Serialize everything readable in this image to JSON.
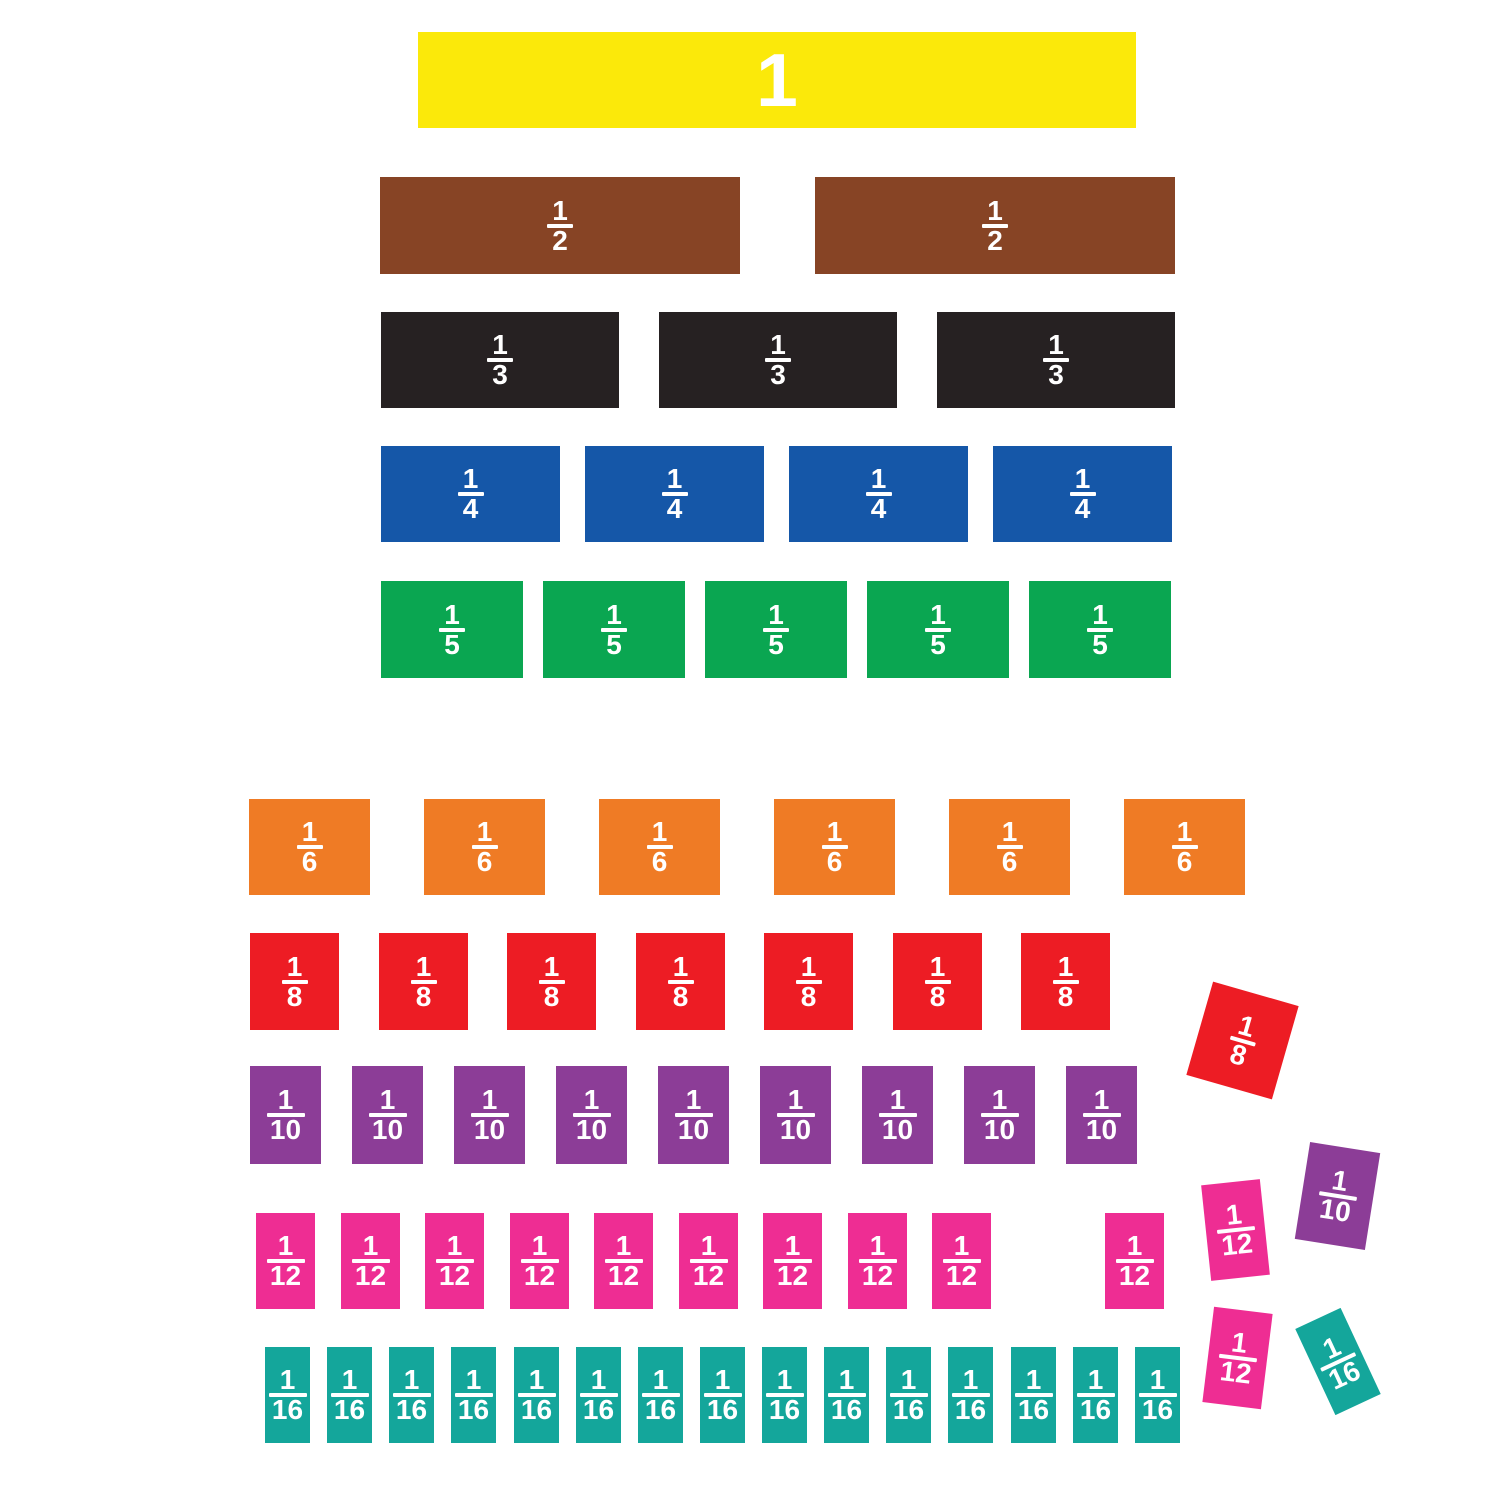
{
  "canvas": {
    "width": 1500,
    "height": 1500,
    "background": "#ffffff",
    "text_color": "#ffffff"
  },
  "rows": [
    {
      "id": "whole",
      "fraction": {
        "num": "1",
        "den": ""
      },
      "whole": true,
      "color": "#FBE90A",
      "y": 32,
      "height": 96,
      "width": 718,
      "xs": [
        418
      ]
    },
    {
      "id": "halves",
      "fraction": {
        "num": "1",
        "den": "2"
      },
      "whole": false,
      "color": "#874425",
      "y": 177,
      "height": 97,
      "width": 360,
      "xs": [
        380,
        815
      ]
    },
    {
      "id": "thirds",
      "fraction": {
        "num": "1",
        "den": "3"
      },
      "whole": false,
      "color": "#262122",
      "y": 312,
      "height": 96,
      "width": 238,
      "xs": [
        381,
        659,
        937
      ]
    },
    {
      "id": "fourths",
      "fraction": {
        "num": "1",
        "den": "4"
      },
      "whole": false,
      "color": "#1557A8",
      "y": 446,
      "height": 96,
      "width": 179,
      "xs": [
        381,
        585,
        789,
        993
      ]
    },
    {
      "id": "fifths",
      "fraction": {
        "num": "1",
        "den": "5"
      },
      "whole": false,
      "color": "#0AA651",
      "y": 581,
      "height": 97,
      "width": 142,
      "xs": [
        381,
        543,
        705,
        867,
        1029
      ]
    },
    {
      "id": "sixths",
      "fraction": {
        "num": "1",
        "den": "6"
      },
      "whole": false,
      "color": "#EF7B25",
      "y": 799,
      "height": 96,
      "width": 121,
      "xs": [
        249,
        424,
        599,
        774,
        949,
        1124
      ]
    },
    {
      "id": "eighths",
      "fraction": {
        "num": "1",
        "den": "8"
      },
      "whole": false,
      "color": "#ED1C24",
      "y": 933,
      "height": 97,
      "width": 89,
      "xs": [
        250,
        379,
        507,
        636,
        764,
        893,
        1021
      ]
    },
    {
      "id": "tenths",
      "fraction": {
        "num": "1",
        "den": "10"
      },
      "whole": false,
      "color": "#8C3D97",
      "y": 1066,
      "height": 98,
      "width": 71,
      "xs": [
        250,
        352,
        454,
        556,
        658,
        760,
        862,
        964,
        1066
      ]
    },
    {
      "id": "twelfths",
      "fraction": {
        "num": "1",
        "den": "12"
      },
      "whole": false,
      "color": "#EE2D93",
      "y": 1213,
      "height": 96,
      "width": 59,
      "xs": [
        256,
        341,
        425,
        510,
        594,
        679,
        763,
        848,
        932,
        1105
      ]
    },
    {
      "id": "sixteenths",
      "fraction": {
        "num": "1",
        "den": "16"
      },
      "whole": false,
      "color": "#14A69B",
      "y": 1347,
      "height": 96,
      "width": 45,
      "xs": [
        265,
        327,
        389,
        451,
        514,
        576,
        638,
        700,
        762,
        824,
        886,
        948,
        1011,
        1073,
        1135
      ]
    }
  ],
  "scattered": [
    {
      "id": "loose-eighth",
      "fraction": {
        "num": "1",
        "den": "8"
      },
      "color": "#ED1C24",
      "cx": 1242,
      "cy": 1040,
      "width": 89,
      "height": 97,
      "rotation": 16
    },
    {
      "id": "loose-tenth",
      "fraction": {
        "num": "1",
        "den": "10"
      },
      "color": "#8C3D97",
      "cx": 1337,
      "cy": 1196,
      "width": 71,
      "height": 98,
      "rotation": 9
    },
    {
      "id": "loose-twelfth-a",
      "fraction": {
        "num": "1",
        "den": "12"
      },
      "color": "#EE2D93",
      "cx": 1235,
      "cy": 1230,
      "width": 59,
      "height": 96,
      "rotation": -6
    },
    {
      "id": "loose-twelfth-b",
      "fraction": {
        "num": "1",
        "den": "12"
      },
      "color": "#EE2D93",
      "cx": 1237,
      "cy": 1358,
      "width": 59,
      "height": 96,
      "rotation": 7
    },
    {
      "id": "loose-sixteenth",
      "fraction": {
        "num": "1",
        "den": "16"
      },
      "color": "#14A69B",
      "cx": 1338,
      "cy": 1361,
      "width": 50,
      "height": 95,
      "rotation": -25
    }
  ]
}
